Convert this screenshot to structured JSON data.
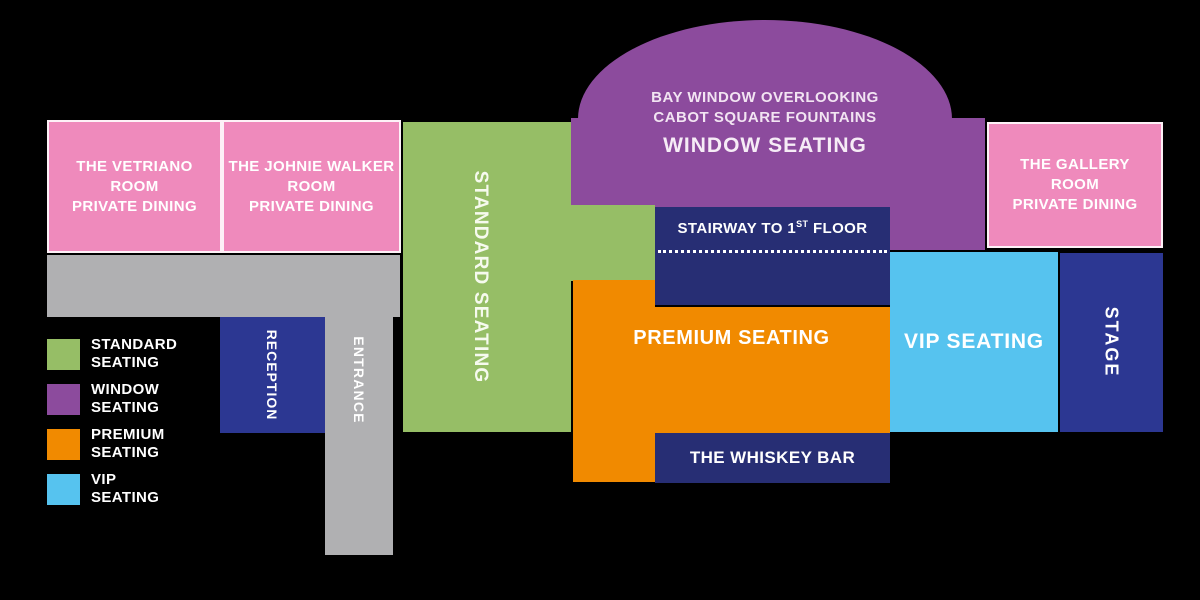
{
  "colors": {
    "background": "#000000",
    "pink": "#EF8ABC",
    "green": "#96BE66",
    "purple": "#8C4B9D",
    "orange": "#F18A00",
    "light_blue": "#56C3EF",
    "navy": "#272E74",
    "royal_blue": "#2C3792",
    "gray": "#B0B0B2",
    "text": "#FFFFFF"
  },
  "rooms": {
    "vetriano": {
      "line1": "THE VETRIANO",
      "line2": "ROOM",
      "line3": "PRIVATE DINING"
    },
    "johnie_walker": {
      "line1": "THE JOHNIE WALKER",
      "line2": "ROOM",
      "line3": "PRIVATE DINING"
    },
    "gallery": {
      "line1": "THE GALLERY",
      "line2": "ROOM",
      "line3": "PRIVATE DINING"
    },
    "standard_seating": {
      "label": "STANDARD SEATING"
    },
    "window_seating": {
      "line1": "BAY WINDOW OVERLOOKING",
      "line2": "CABOT SQUARE FOUNTAINS",
      "title": "WINDOW SEATING"
    },
    "stairway": {
      "prefix": "STAIRWAY TO 1",
      "sup": "ST",
      "suffix": " FLOOR"
    },
    "premium_seating": {
      "label": "PREMIUM SEATING"
    },
    "whiskey_bar": {
      "label": "THE WHISKEY BAR"
    },
    "vip_seating": {
      "label": "VIP SEATING"
    },
    "stage": {
      "label": "STAGE"
    },
    "reception": {
      "label": "RECEPTION"
    },
    "entrance": {
      "label": "ENTRANCE"
    }
  },
  "legend": {
    "items": [
      {
        "line1": "STANDARD",
        "line2": "SEATING",
        "color": "#96BE66"
      },
      {
        "line1": "WINDOW",
        "line2": "SEATING",
        "color": "#8C4B9D"
      },
      {
        "line1": "PREMIUM",
        "line2": "SEATING",
        "color": "#F18A00"
      },
      {
        "line1": "VIP",
        "line2": "SEATING",
        "color": "#56C3EF"
      }
    ]
  }
}
